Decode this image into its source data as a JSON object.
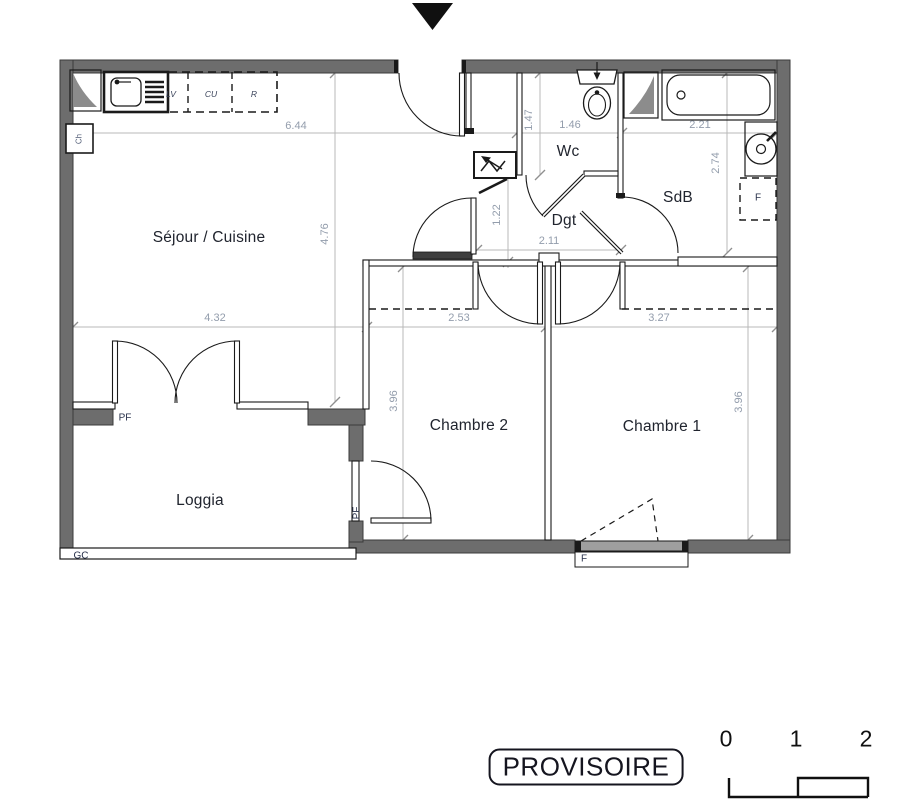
{
  "plan": {
    "rooms": [
      {
        "id": "sejour",
        "label": "Séjour / Cuisine"
      },
      {
        "id": "wc",
        "label": "Wc"
      },
      {
        "id": "dgt",
        "label": "Dgt"
      },
      {
        "id": "sdb",
        "label": "SdB"
      },
      {
        "id": "chambre2",
        "label": "Chambre 2"
      },
      {
        "id": "chambre1",
        "label": "Chambre 1"
      },
      {
        "id": "loggia",
        "label": "Loggia"
      }
    ],
    "dimensions": {
      "top_sejour": "6.44",
      "top_wc": "1.46",
      "top_sdb": "2.21",
      "wc_depth": "1.47",
      "sdb_depth": "2.74",
      "sejour_depth": "4.76",
      "dgt_depth": "1.22",
      "dgt_width": "2.11",
      "mid_sejour": "4.32",
      "mid_chambre2": "2.53",
      "mid_chambre1": "3.27",
      "chambre2_depth": "3.96",
      "chambre1_depth": "3.96"
    },
    "annotations": {
      "pf_sejour": "PF",
      "pf_loggia": "PF",
      "gc": "GC",
      "f_window": "F",
      "f_sdb": "F",
      "kitchen_lv": "LV",
      "kitchen_cu": "CU",
      "kitchen_r": "R",
      "boiler": "Ch"
    },
    "stamp": {
      "text": "PROVISOIRE"
    },
    "scale_bar": {
      "labels": [
        "0",
        "1",
        "2"
      ]
    },
    "colors": {
      "wall": "#6d6d6d",
      "ink": "#1a1a1a",
      "dim_line": "#b8b8b8",
      "dim_text": "#939dac",
      "room_label": "#20242e"
    }
  }
}
